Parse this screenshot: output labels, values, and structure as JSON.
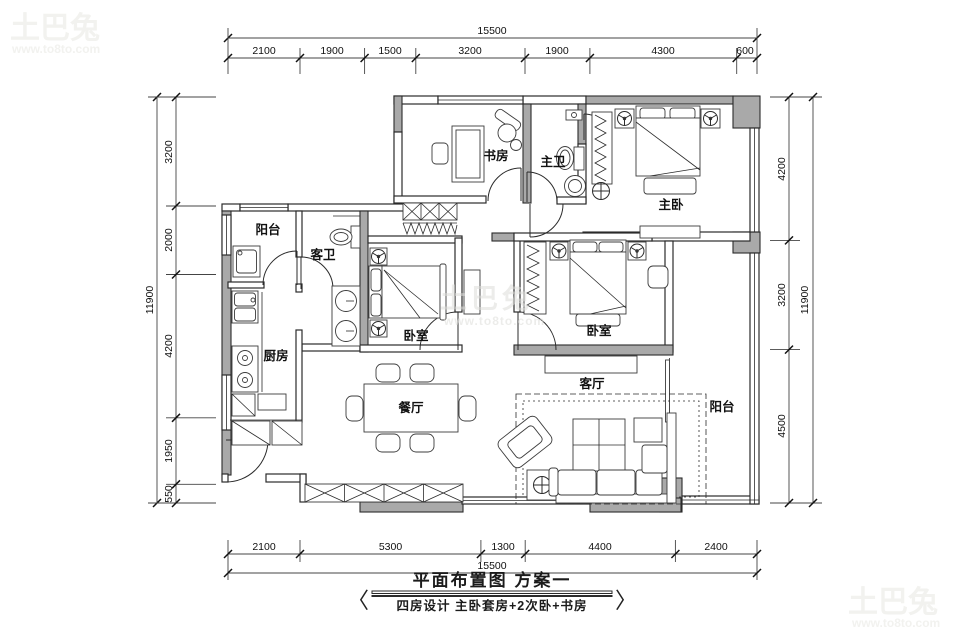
{
  "watermark": {
    "brand": "土巴兔",
    "url": "www.to8to.com"
  },
  "title": {
    "main": "平面布置图 方案一",
    "sub": "四房设计 主卧套房+2次卧+书房",
    "bracket_left": "〈",
    "bracket_right": "〉"
  },
  "rooms": {
    "study": {
      "label": "书房"
    },
    "master_bath": {
      "label": "主卫"
    },
    "master_bedroom": {
      "label": "主卧"
    },
    "balcony_nw": {
      "label": "阳台"
    },
    "guest_bath": {
      "label": "客卫"
    },
    "bedroom_left": {
      "label": "卧室"
    },
    "bedroom_right": {
      "label": "卧室"
    },
    "kitchen": {
      "label": "厨房"
    },
    "dining": {
      "label": "餐厅"
    },
    "living": {
      "label": "客厅"
    },
    "balcony_se": {
      "label": "阳台"
    }
  },
  "dimensions": {
    "top": {
      "total": "15500",
      "segments": [
        "2100",
        "1900",
        "1500",
        "3200",
        "1900",
        "4300",
        "600"
      ]
    },
    "bottom": {
      "total": "15500",
      "segments": [
        "2100",
        "5300",
        "1300",
        "4400",
        "2400"
      ]
    },
    "left": {
      "total": "11900",
      "segments": [
        "3200",
        "2000",
        "4200",
        "1950",
        "550"
      ]
    },
    "right": {
      "total": "11900",
      "segments": [
        "4200",
        "3200",
        "4500"
      ]
    }
  },
  "colors": {
    "wall_fill": "#a9a9a9",
    "line": "#2b2b2b",
    "watermark": "#f2f2ef"
  }
}
